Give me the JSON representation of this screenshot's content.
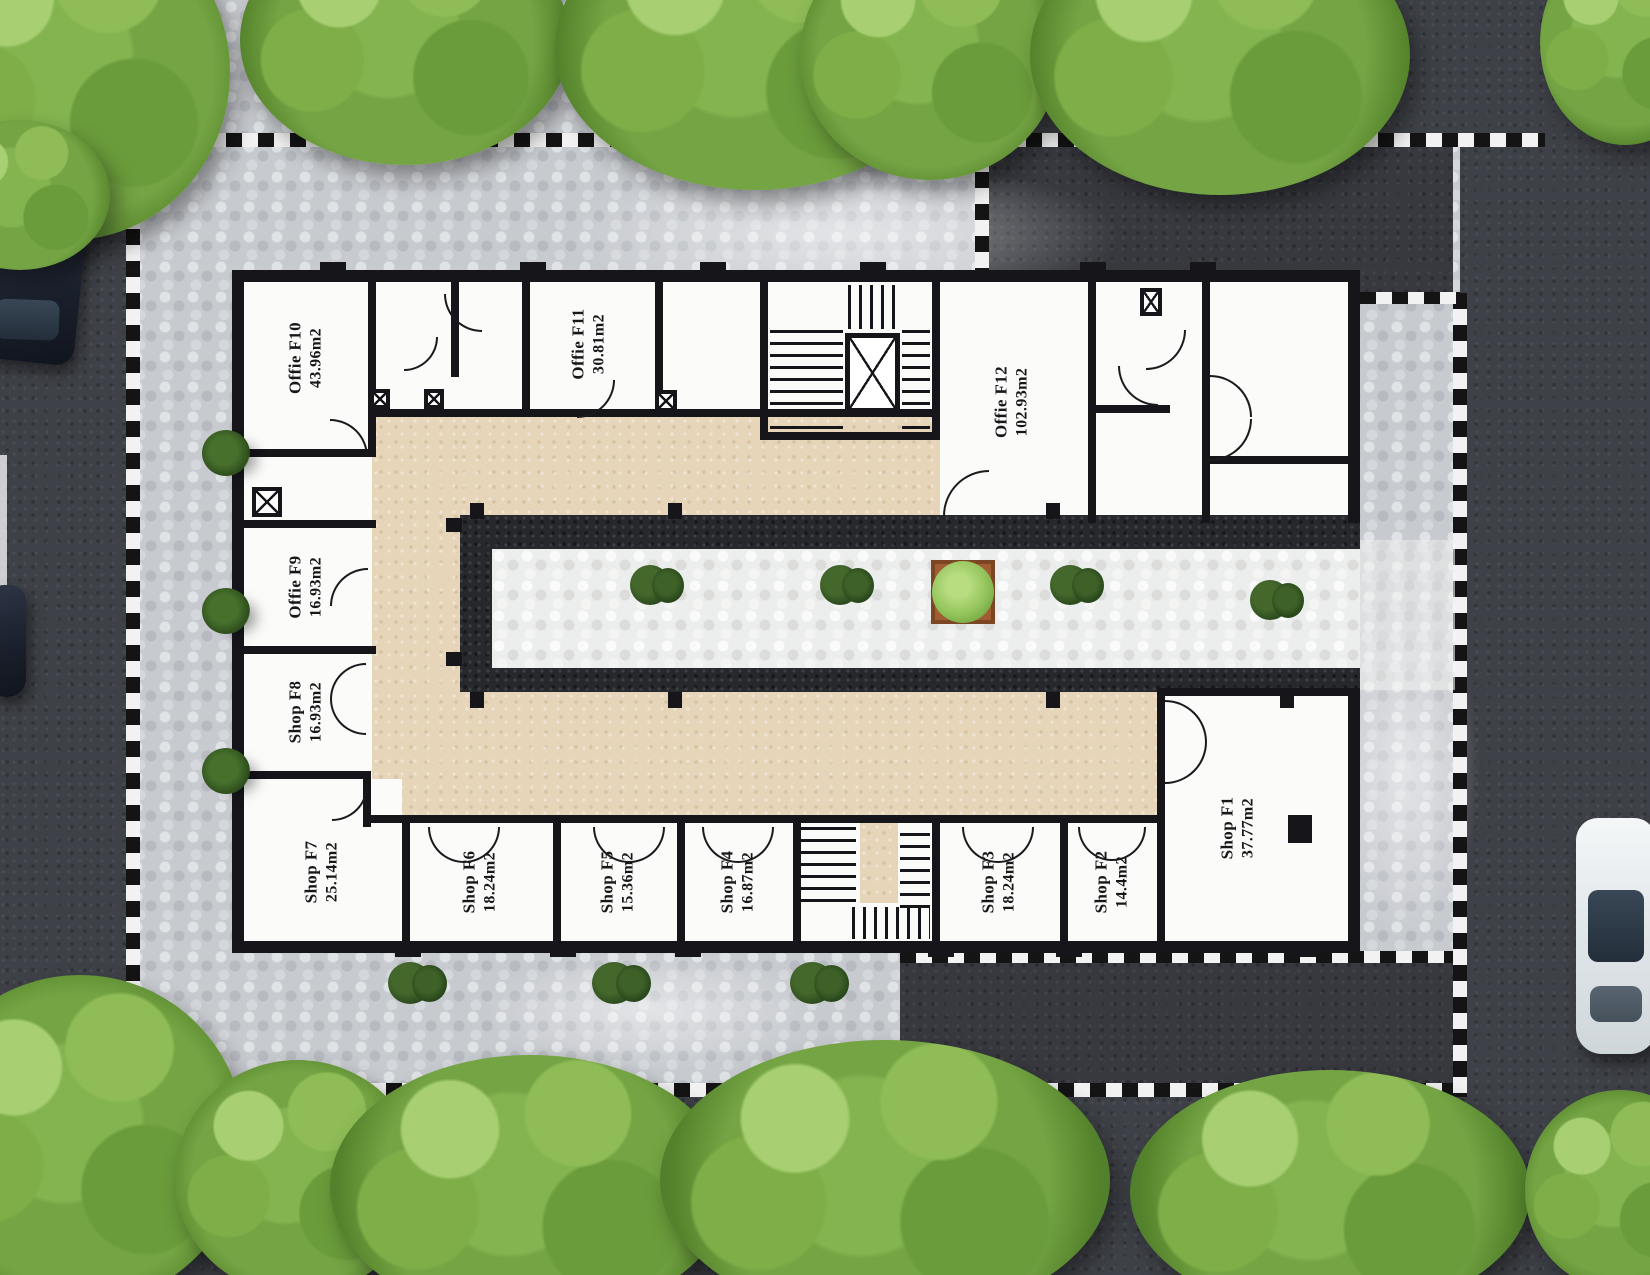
{
  "document": {
    "kind": "commercial-floor-plan-top-view",
    "floor_code_prefix": "F",
    "unit_count": 12
  },
  "units": [
    {
      "id": "F10",
      "name": "Offie F10",
      "area": "43.96m2",
      "type": "office"
    },
    {
      "id": "F11",
      "name": "Offie F11",
      "area": "30.81m2",
      "type": "office"
    },
    {
      "id": "F12",
      "name": "Offie F12",
      "area": "102.93m2",
      "type": "office"
    },
    {
      "id": "F9",
      "name": "Offie F9",
      "area": "16.93m2",
      "type": "office"
    },
    {
      "id": "F8",
      "name": "Shop F8",
      "area": "16.93m2",
      "type": "shop"
    },
    {
      "id": "F7",
      "name": "Shop F7",
      "area": "25.14m2",
      "type": "shop"
    },
    {
      "id": "F6",
      "name": "Shop F6",
      "area": "18.24m2",
      "type": "shop"
    },
    {
      "id": "F5",
      "name": "Shop F5",
      "area": "15.36m2",
      "type": "shop"
    },
    {
      "id": "F4",
      "name": "Shop F4",
      "area": "16.87m2",
      "type": "shop"
    },
    {
      "id": "F3",
      "name": "Shop F3",
      "area": "18.24m2",
      "type": "shop"
    },
    {
      "id": "F2",
      "name": "Shop F2",
      "area": "14.4m2",
      "type": "shop"
    },
    {
      "id": "F1",
      "name": "Shop F1",
      "area": "37.77m2",
      "type": "shop"
    }
  ],
  "colors": {
    "corridor_beige": "#e6d5b9",
    "room_white": "#fbfbfa",
    "wall_black": "#15151a",
    "courtyard_frame_dark": "#26282c",
    "plaza_gray": "#c7cacf",
    "courtyard_tile": "#eceded",
    "asphalt": "#3e4147",
    "tree_green": "#74a443",
    "shrub_green": "#2d4d1c",
    "planter_terracotta": "#a05d33",
    "checker_dark": "#141414",
    "checker_light": "#f2f2f2"
  },
  "environment": {
    "vehicles": [
      {
        "icon": "car-top-view",
        "color": "dark-navy",
        "location": "top-left-road"
      },
      {
        "icon": "car-top-view",
        "color": "dark",
        "location": "left-road-edge"
      },
      {
        "icon": "car-top-view",
        "color": "white",
        "location": "right-road"
      }
    ],
    "vegetation": {
      "canopy_trees": 13,
      "palm_shrubs_left": 3,
      "courtyard_shrubs": 4,
      "courtyard_planter": 1,
      "south_plaza_shrubs": 3
    },
    "features": [
      "checkered-plaza-border",
      "hexagonal-paving",
      "stair-core-with-elevator",
      "south-stair-core"
    ]
  }
}
